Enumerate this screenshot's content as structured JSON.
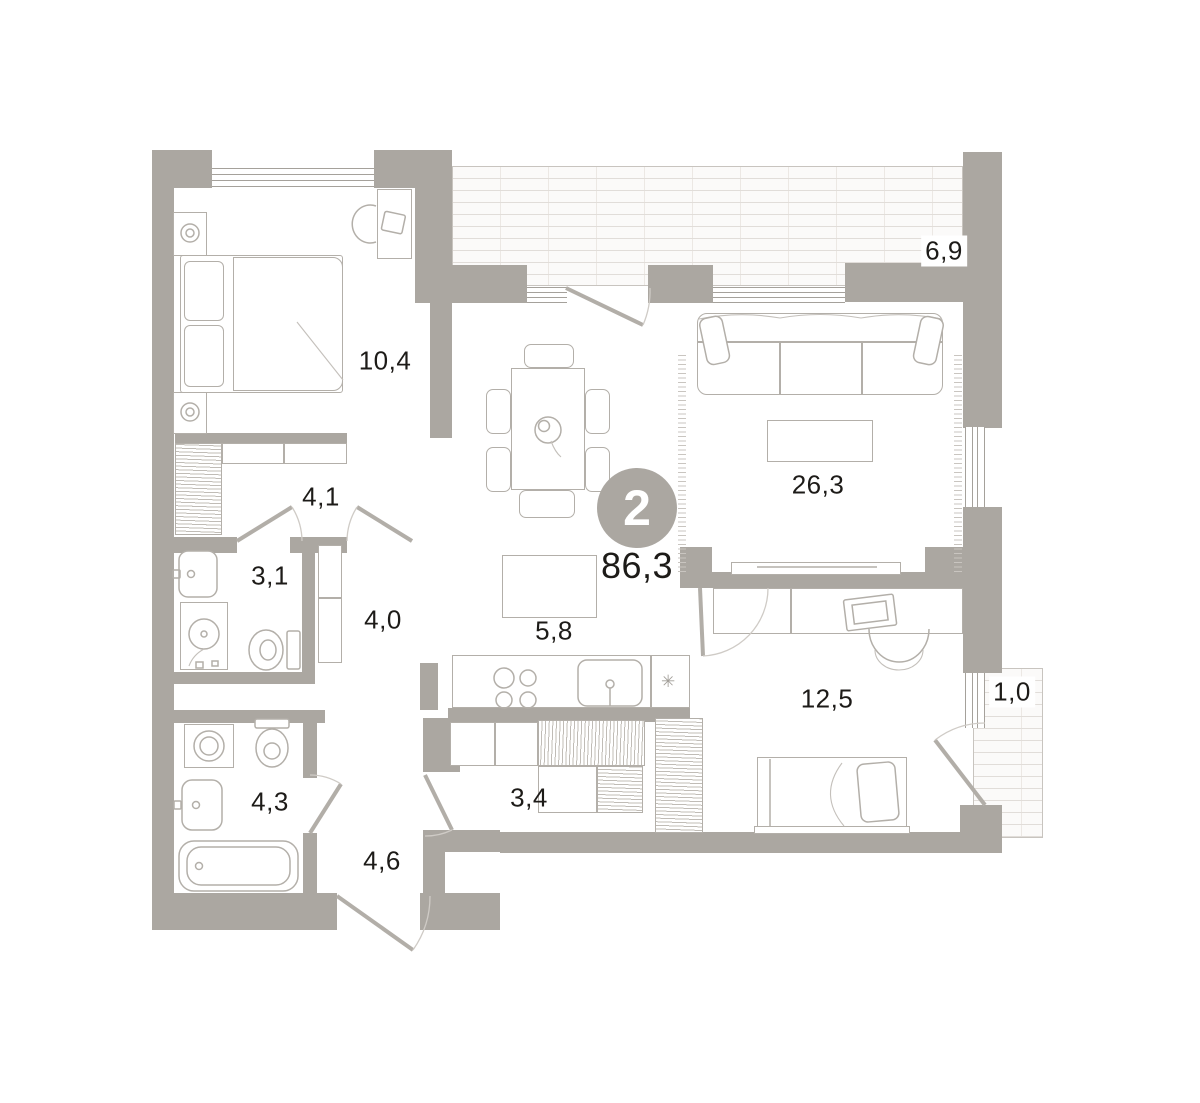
{
  "plan": {
    "apartment": {
      "rooms_badge": "2",
      "total_area": "86,3"
    },
    "icons": {
      "fridge": "✳"
    },
    "colors": {
      "wall": "#aba7a1",
      "furniture_line": "#b3afa9",
      "text": "#1d1b18",
      "brick_line": "#e1ddd9"
    },
    "rooms": [
      {
        "id": "bedroom-main",
        "area": "10,4"
      },
      {
        "id": "wardrobe",
        "area": "4,1"
      },
      {
        "id": "bathroom-1",
        "area": "3,1"
      },
      {
        "id": "corridor",
        "area": "4,0"
      },
      {
        "id": "kitchen",
        "area": "5,8"
      },
      {
        "id": "living-room",
        "area": "26,3"
      },
      {
        "id": "loggia",
        "area": "6,9"
      },
      {
        "id": "bedroom-2",
        "area": "12,5"
      },
      {
        "id": "balcony",
        "area": "1,0"
      },
      {
        "id": "bathroom-2",
        "area": "4,3"
      },
      {
        "id": "closet",
        "area": "3,4"
      },
      {
        "id": "hallway",
        "area": "4,6"
      }
    ]
  }
}
